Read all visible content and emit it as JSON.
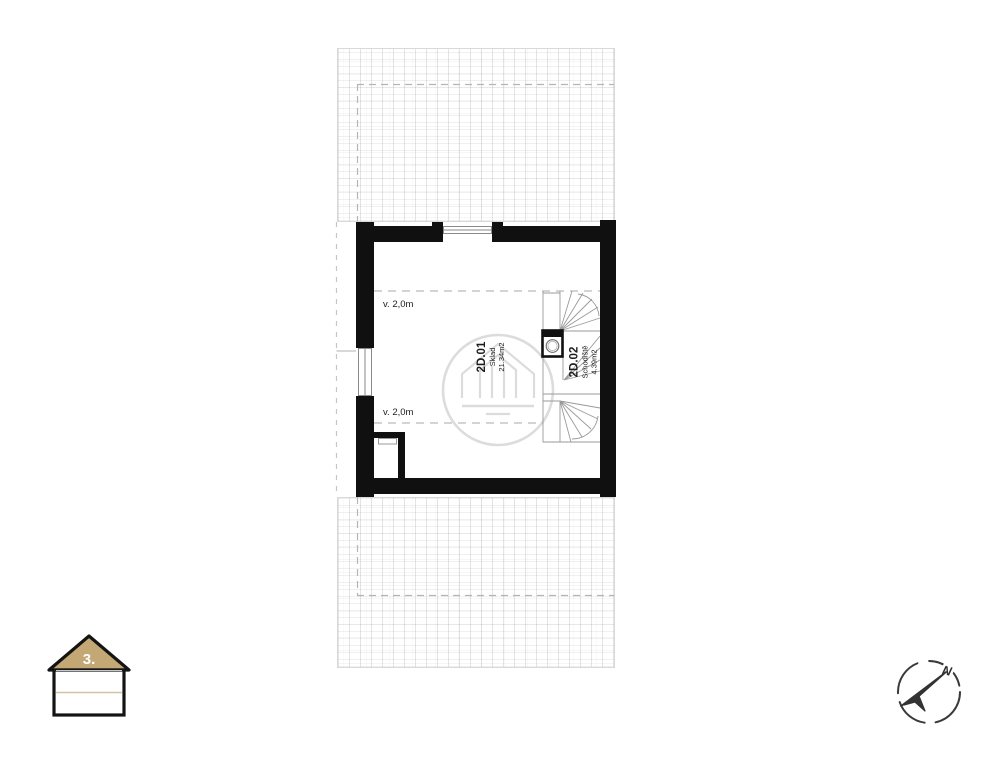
{
  "plan": {
    "floor_label": "3.",
    "rooms": [
      {
        "id": "2D.01",
        "name": "Sklad",
        "area": "21.34m2"
      },
      {
        "id": "2D.02",
        "name": "Schodiště",
        "area": "4.39m2"
      }
    ],
    "height_labels": {
      "upper": "v. 2,0m",
      "lower": "v. 2,0m"
    },
    "compass": {
      "north_label": "N"
    }
  },
  "colors": {
    "wall": "#101010",
    "thin_line": "#9a9a9a",
    "dashed_line": "#b5b5b5",
    "watermark": "#dcdcdc",
    "floor_roof_fill": "#c3a876",
    "compass_stroke": "#3a3a3a"
  }
}
